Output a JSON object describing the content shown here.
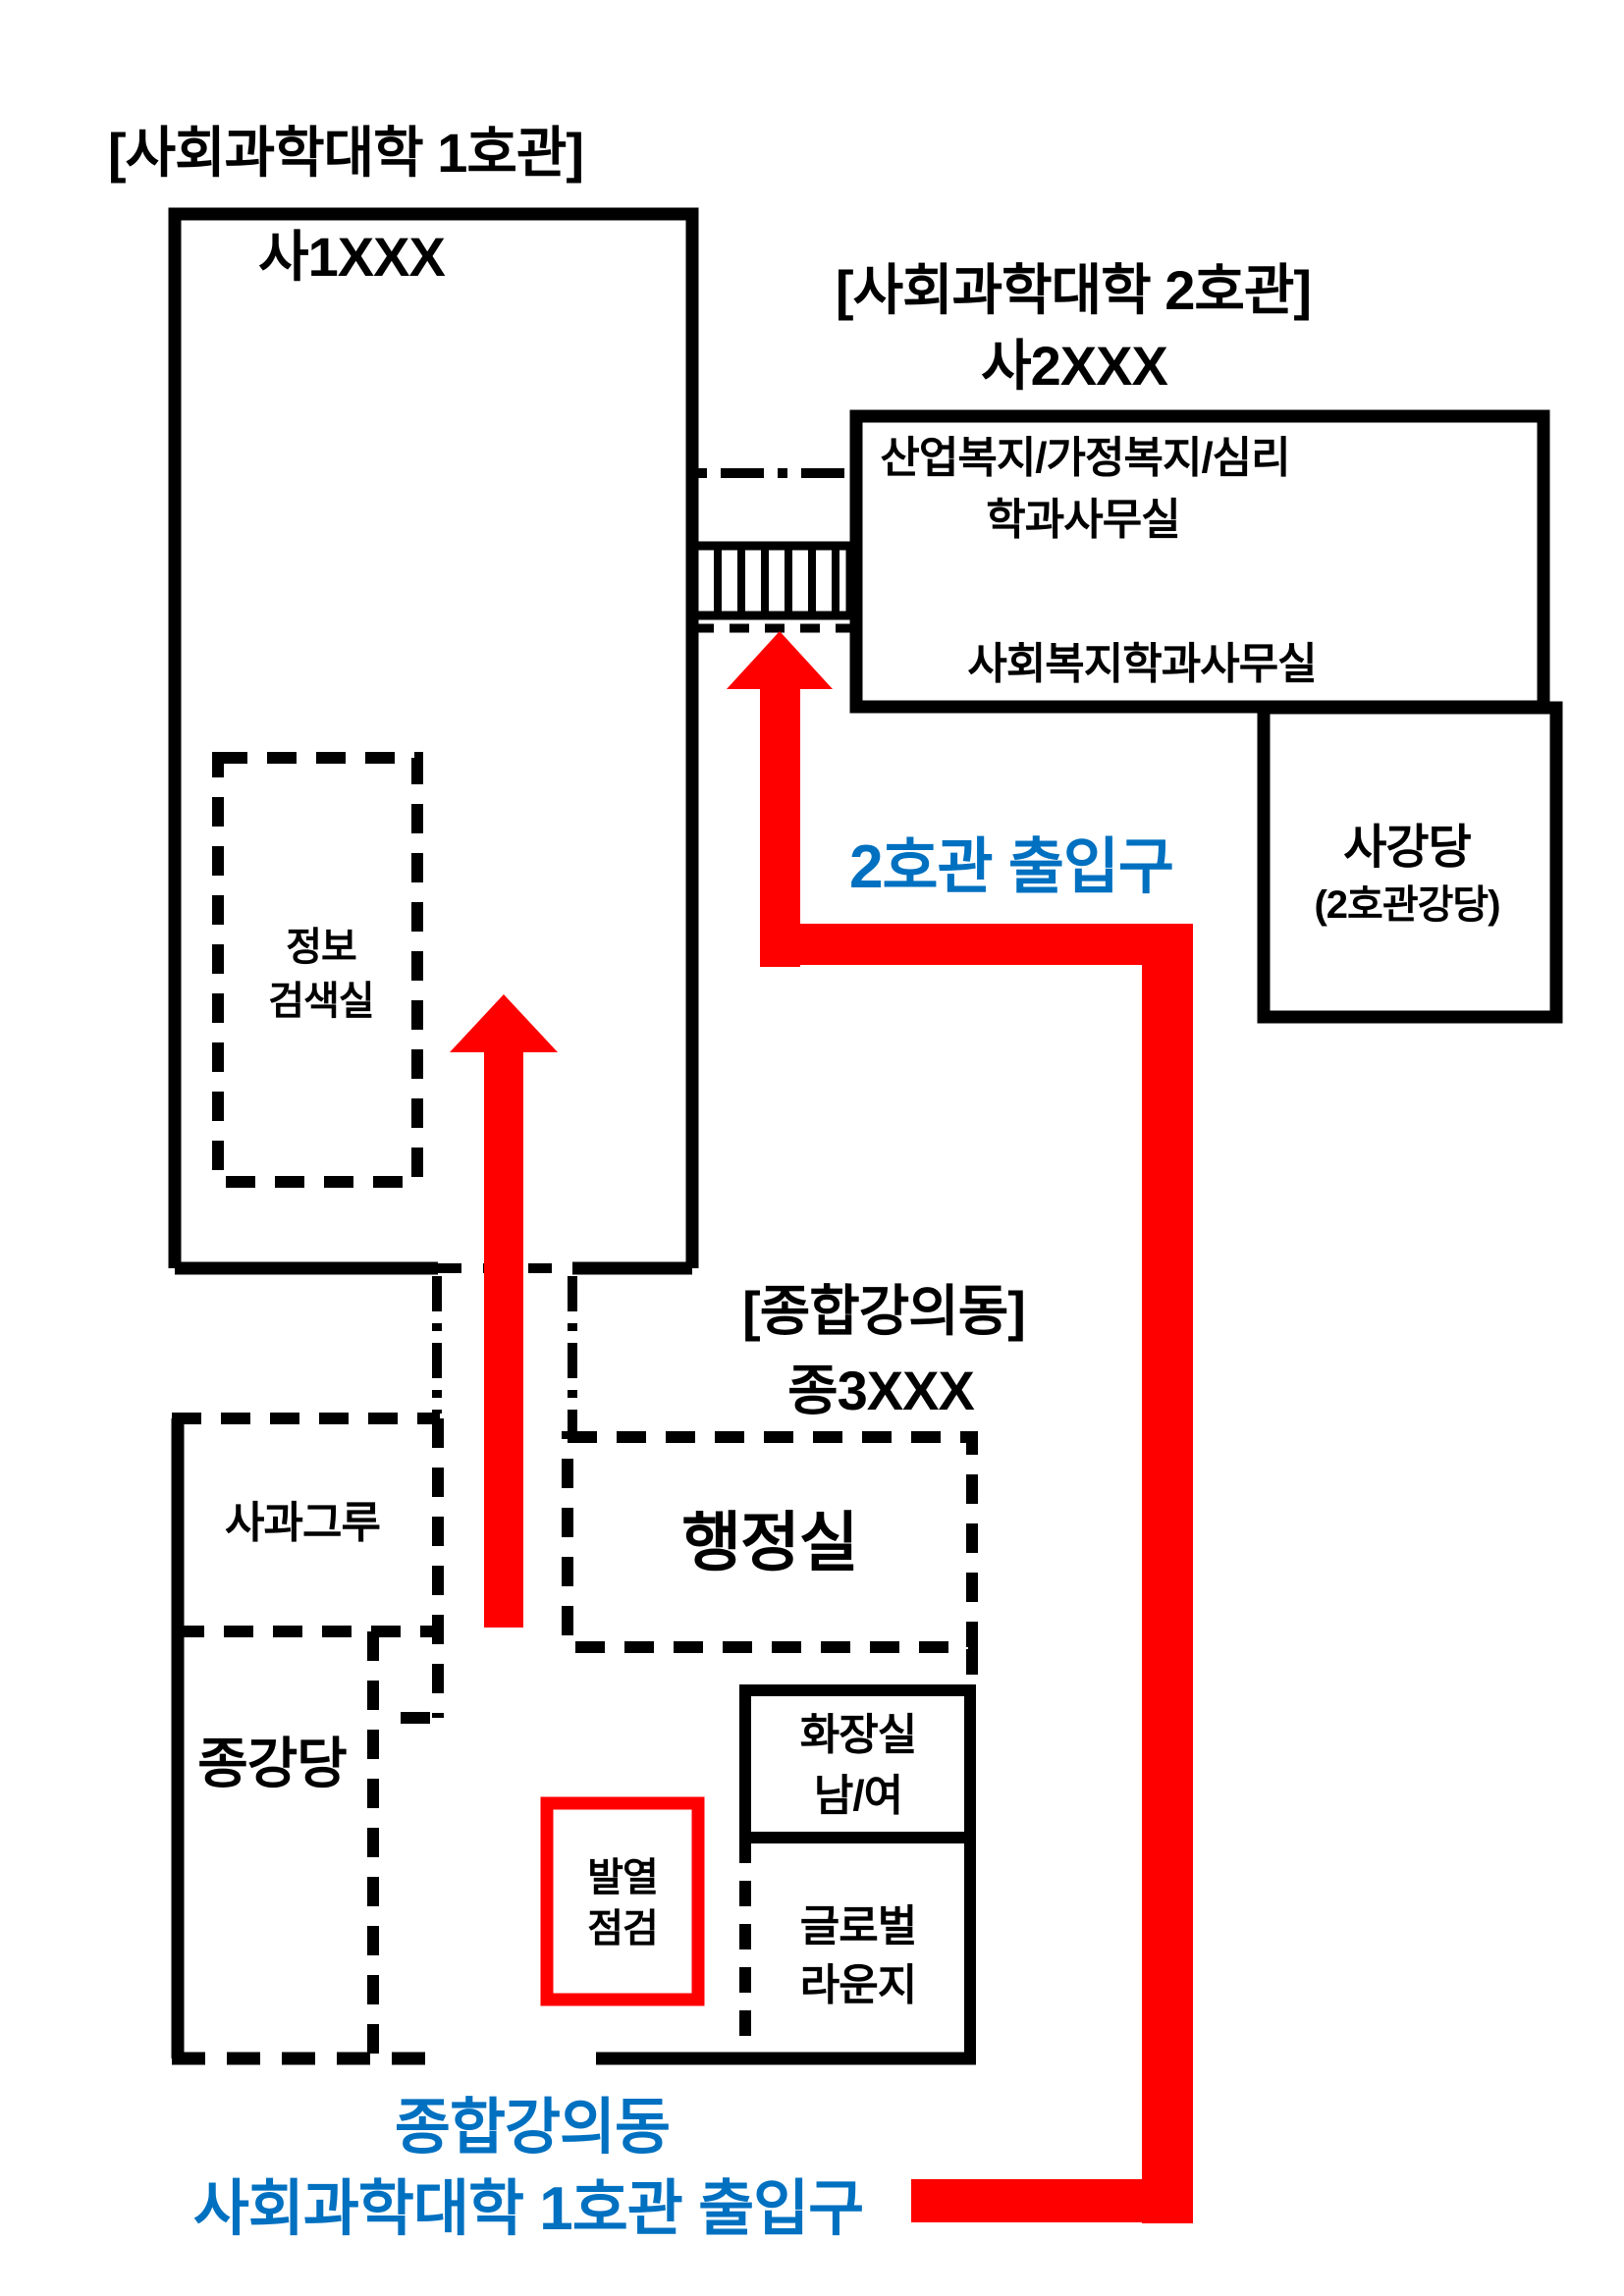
{
  "colors": {
    "accent_blue": "#0070C0",
    "route_red": "#FF0000",
    "outline_black": "#000000"
  },
  "building1": {
    "title": "[사회과학대학 1호관]",
    "code": "사1XXX",
    "info_room": {
      "line1": "정보",
      "line2": "검색실"
    }
  },
  "building2": {
    "title": "[사회과학대학 2호관]",
    "code": "사2XXX",
    "office_welfare": {
      "line1": "산업복지/가정복지/심리",
      "line2": "학과사무실"
    },
    "office_social": "사회복지학과사무실",
    "auditorium": {
      "line1": "사강당",
      "line2": "(2호관강당)"
    },
    "entrance_label": "2호관 출입구"
  },
  "lecture_building": {
    "title": "[종합강의동]",
    "code": "종3XXX",
    "admin_office": "행정실",
    "sagwa_guru": "사과그루",
    "auditorium": "종강당",
    "restroom": {
      "line1": "화장실",
      "line2": "남/여"
    },
    "global_lounge": {
      "line1": "글로벌",
      "line2": "라운지"
    },
    "fever_check": {
      "line1": "발열",
      "line2": "점검"
    }
  },
  "bottom_entrance": {
    "line1": "종합강의동",
    "line2": "사회과학대학 1호관 출입구"
  }
}
